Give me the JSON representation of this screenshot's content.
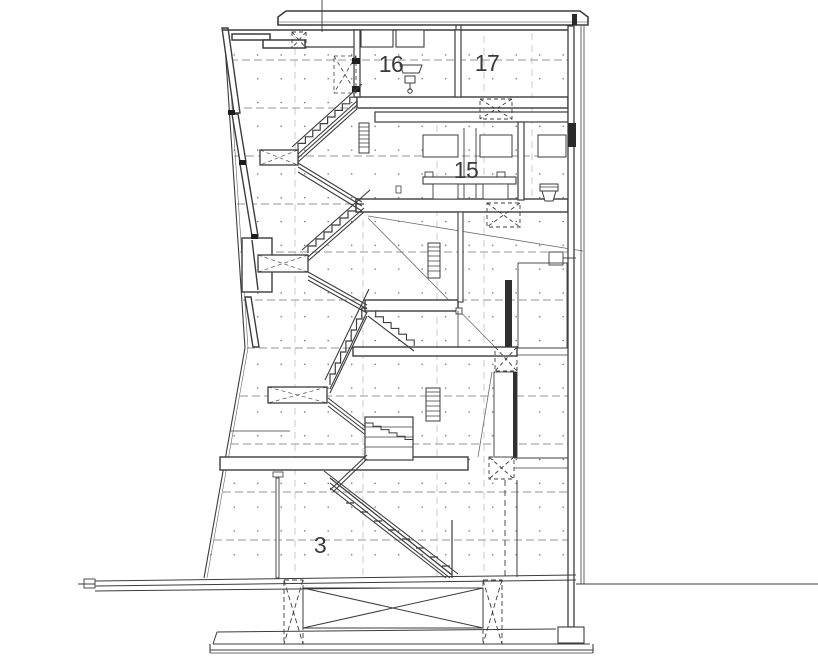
{
  "page": {
    "background": "#ffffff",
    "width": 818,
    "height": 660
  },
  "drawing": {
    "kind": "architectural-building-section",
    "colors": {
      "line": "#3c3c3c",
      "dark": "#1c1c1c",
      "dash": "#979797",
      "dot": "#6e6e6e"
    },
    "room_labels": {
      "r16": "16",
      "r17": "17",
      "r15": "15",
      "r3": "3"
    }
  }
}
